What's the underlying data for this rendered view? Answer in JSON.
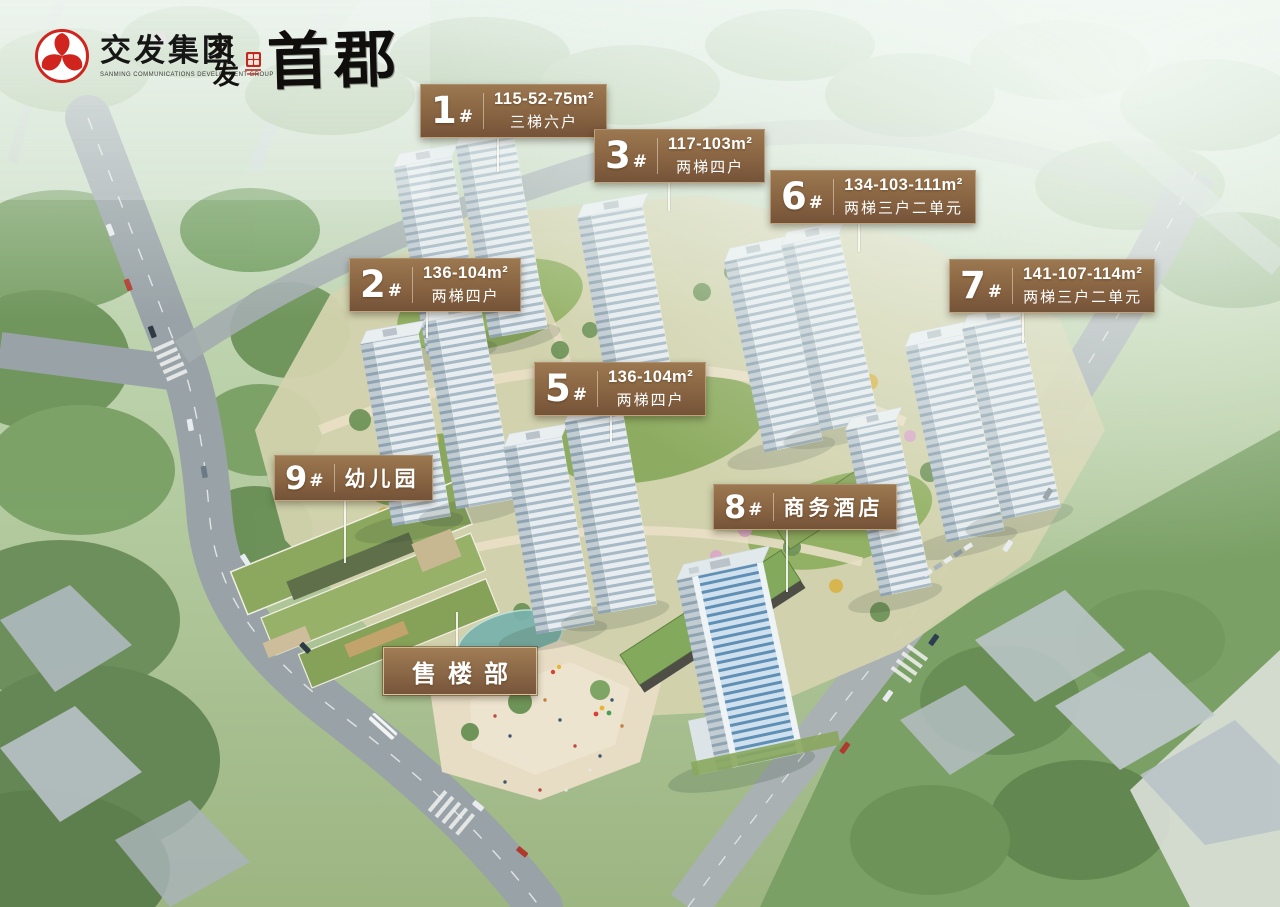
{
  "branding": {
    "group_name": "交发集团",
    "group_subtitle": "SANMING COMMUNICATIONS DEVELOPMENT GROUP",
    "project_prefix_top": "交",
    "project_prefix_bottom": "发",
    "project_name": "首郡"
  },
  "building_labels": [
    {
      "number": "1",
      "suffix": "#",
      "area": "115-52-75m²",
      "layout": "三梯六户"
    },
    {
      "number": "3",
      "suffix": "#",
      "area": "117-103m²",
      "layout": "两梯四户"
    },
    {
      "number": "6",
      "suffix": "#",
      "area": "134-103-111m²",
      "layout": "两梯三户二单元"
    },
    {
      "number": "2",
      "suffix": "#",
      "area": "136-104m²",
      "layout": "两梯四户"
    },
    {
      "number": "7",
      "suffix": "#",
      "area": "141-107-114m²",
      "layout": "两梯三户二单元"
    },
    {
      "number": "5",
      "suffix": "#",
      "area": "136-104m²",
      "layout": "两梯四户"
    },
    {
      "number": "9",
      "suffix": "#",
      "name": "幼儿园"
    },
    {
      "number": "8",
      "suffix": "#",
      "name": "商务酒店"
    }
  ],
  "sales_label": {
    "name": "售楼部"
  },
  "palette": {
    "label_gradient_top": "#9B7850",
    "label_gradient_bottom": "#755338",
    "label_border": "#F2DFBA",
    "brand_red": "#C1271D",
    "pointer_line": "#FAF9F3"
  }
}
